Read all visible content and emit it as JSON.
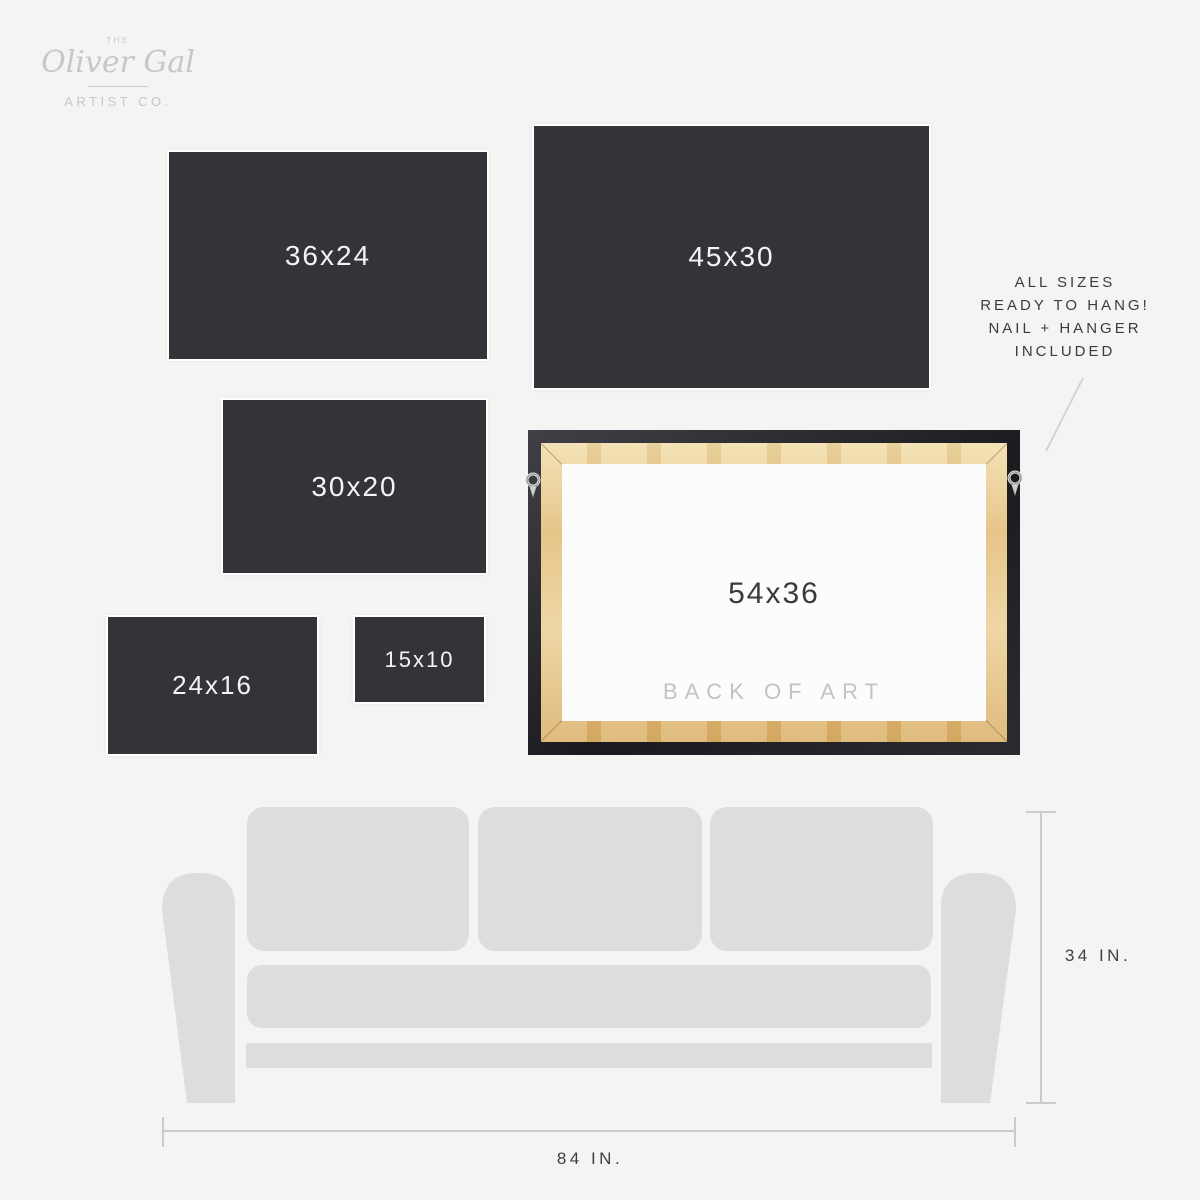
{
  "brand": {
    "the": "THE",
    "name": "Oliver Gal",
    "subtitle": "ARTIST CO."
  },
  "sizes": [
    {
      "label": "36x24"
    },
    {
      "label": "45x30"
    },
    {
      "label": "30x20"
    },
    {
      "label": "24x16"
    },
    {
      "label": "15x10"
    }
  ],
  "frame": {
    "size_label": "54x36",
    "caption": "BACK OF ART"
  },
  "note": {
    "lines": [
      "ALL SIZES",
      "READY TO HANG!",
      "NAIL + HANGER",
      "INCLUDED"
    ]
  },
  "dimensions": {
    "couch_height": "34 IN.",
    "couch_width": "84 IN."
  },
  "colors": {
    "background": "#f4f4f3",
    "swatch_dark": "#343438",
    "swatch_text": "#f4f4f4",
    "couch_gray": "#dcdddc",
    "wood_tan": "#e7c583",
    "frame_black": "#232327",
    "logo_gray": "#c7c7c7",
    "caption_gray": "#c3c3c3",
    "dim_line_gray": "#cbcbcb",
    "dim_text_dark": "#3f3f3f"
  }
}
